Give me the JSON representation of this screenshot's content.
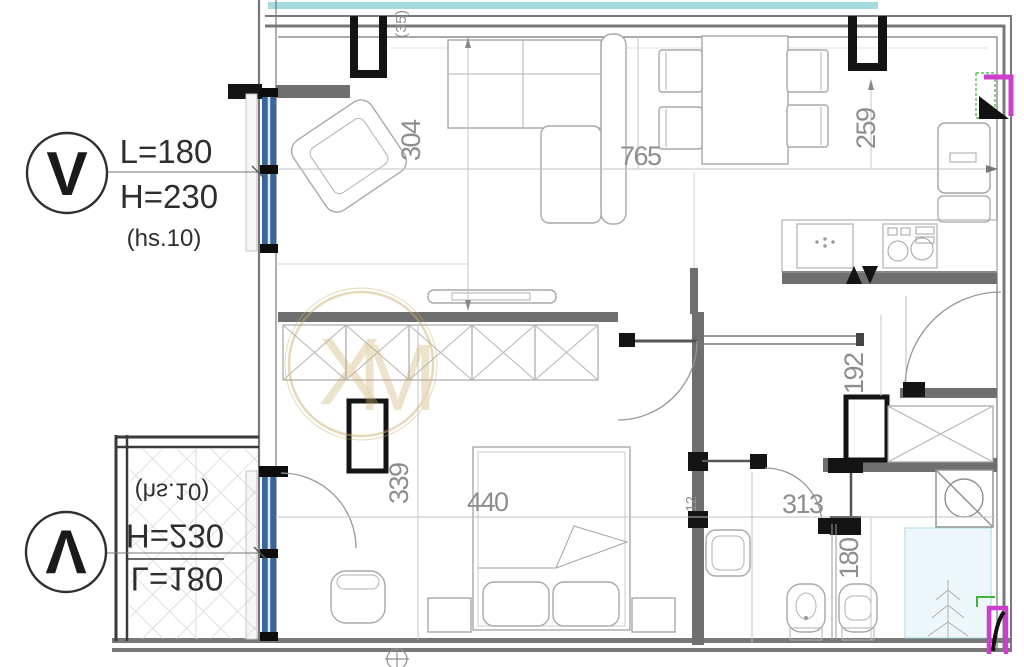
{
  "page": {
    "title": "Apartment floor plan drawing"
  },
  "window_specs": {
    "top": {
      "symbol": "V",
      "length": "L=180",
      "height": "H=230",
      "note": "(hs.10)"
    },
    "bottom": {
      "symbol": "V",
      "length": "L=180",
      "height": "H=230",
      "note": "(hs.10)"
    }
  },
  "dimensions": {
    "living_depth": "304",
    "living_width": "765",
    "kitchen_side": "259",
    "top_note": "(35)",
    "bedroom_depth": "339",
    "bed_wall": "440",
    "partition": "12",
    "bath_width": "313",
    "entry_side": "192",
    "bath_side": "180"
  },
  "colors": {
    "window_blue": "#38679f",
    "wall_gray": "#6f6f6f",
    "cyan_strip": "#a3dbde",
    "glass_cyan": "#8fd2d8",
    "highlight_magenta": "#cc3fcc",
    "highlight_green": "#3db53d",
    "watermark_gold": "#c9ad67"
  }
}
